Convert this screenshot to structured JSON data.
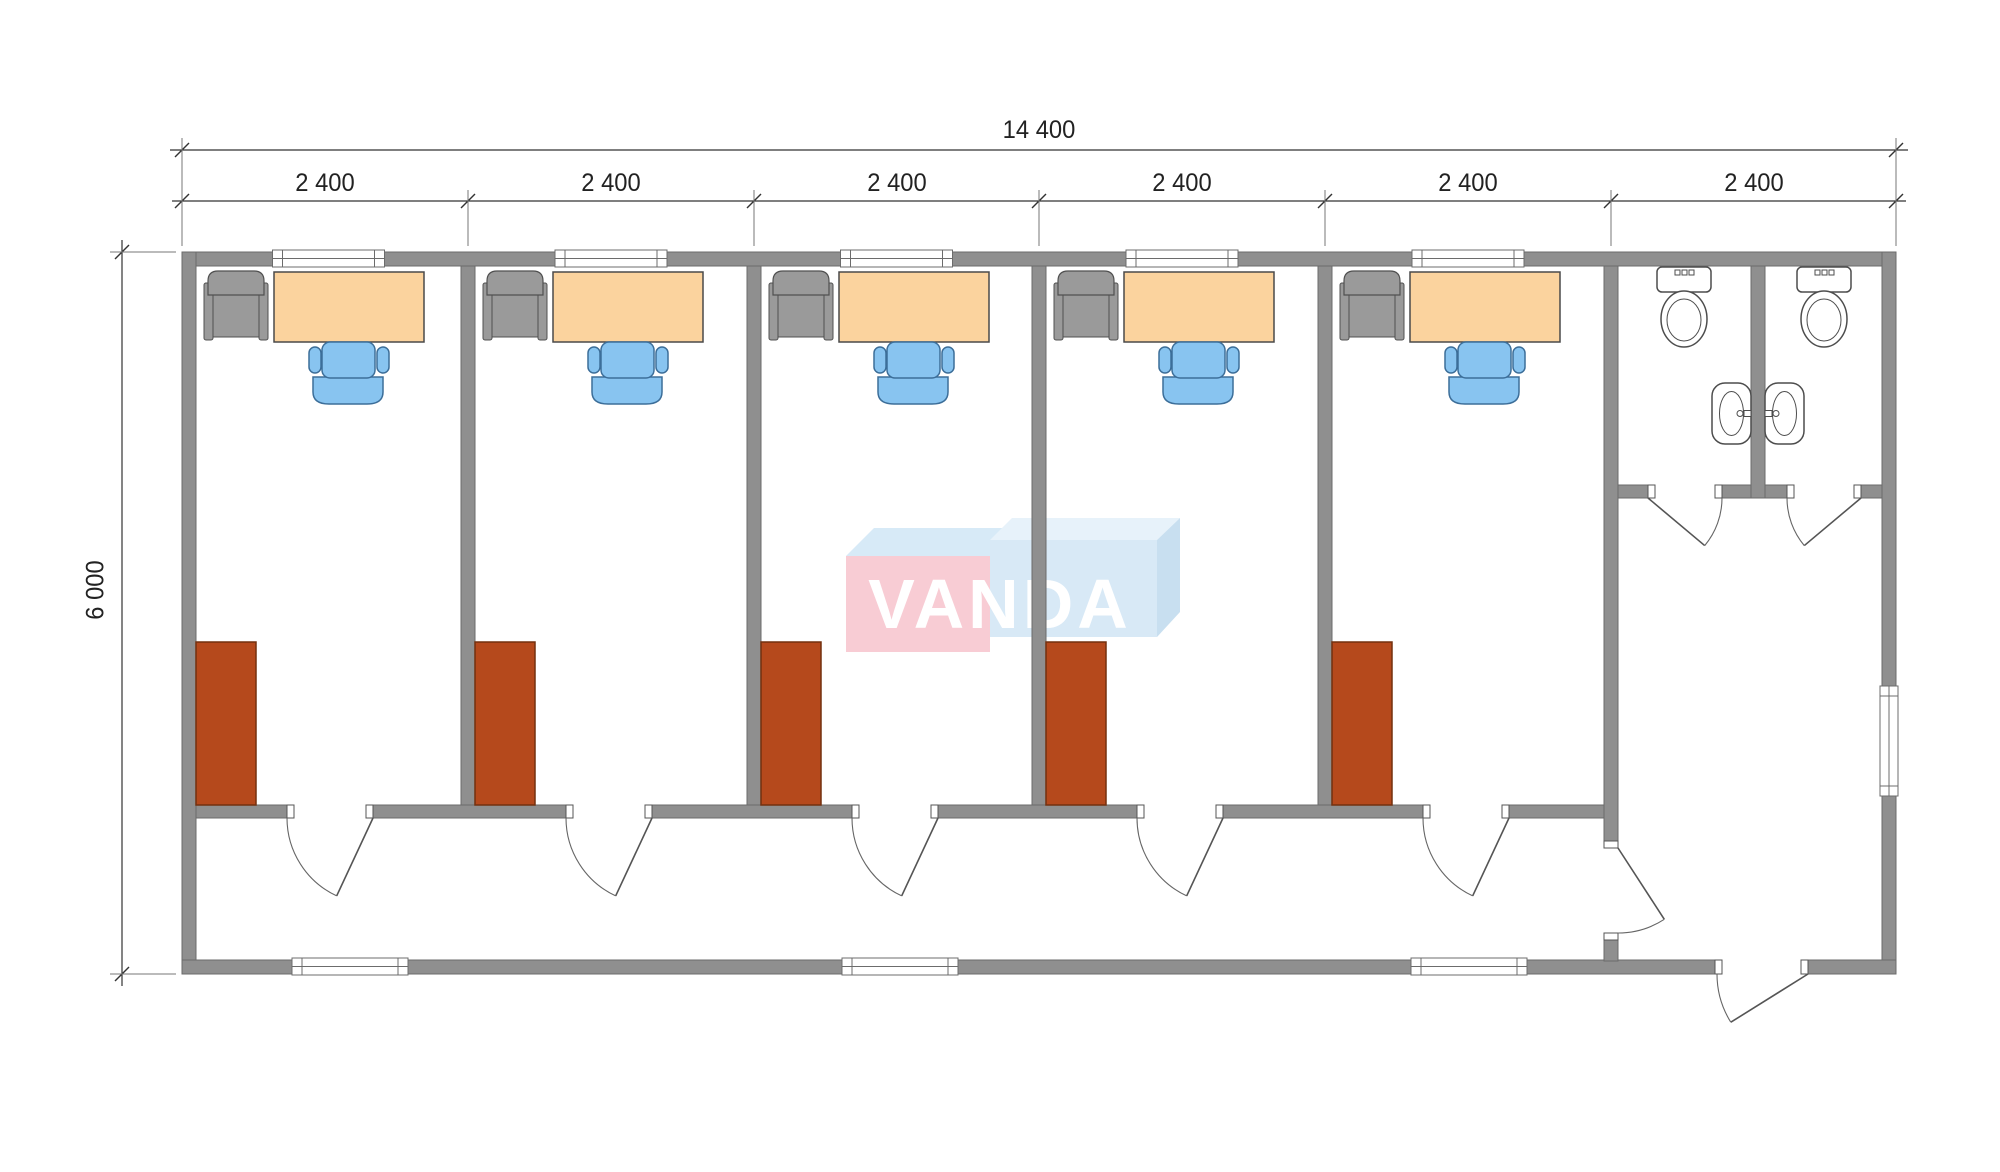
{
  "watermark": {
    "text": "VANDA"
  },
  "dimensions": {
    "total": "14 400",
    "segments": [
      "2 400",
      "2 400",
      "2 400",
      "2 400",
      "2 400",
      "2 400"
    ],
    "height": "6 000"
  },
  "colors": {
    "wall": "#8f8f8f",
    "wallEdge": "#6b6b6b",
    "line": "#4d4d4d",
    "dim": "#333333",
    "desk": "#fbd39e",
    "deskEdge": "#4a4a4a",
    "armchair": "#9a9a9a",
    "armchairEdge": "#505050",
    "chair": "#88c4f0",
    "chairEdge": "#3c6e99",
    "wardrobe": "#b5491c",
    "wardrobeEdge": "#73300f",
    "windowFrame": "#6c6c6c",
    "wmPinkFront": "#f8ccd4",
    "wmPinkTop": "#d7eaf7",
    "wmBlueFront": "#d8e9f6",
    "wmBlueTop": "#e7f2fa",
    "wmBlueSide": "#c8dff0",
    "wmText": "#ffffff"
  },
  "plan": {
    "canvas": {
      "w": 2000,
      "h": 1172
    },
    "wallThickness": 14,
    "outer": {
      "x1": 182,
      "y1": 252,
      "x2": 1896,
      "y2": 974
    },
    "boundaries": [
      182,
      468,
      754,
      1039,
      1325,
      1611,
      1896
    ],
    "dividers": [
      461,
      747,
      1032,
      1318
    ],
    "rooms": [
      {
        "x": 196,
        "w": 265
      },
      {
        "x": 475,
        "w": 272
      },
      {
        "x": 761,
        "w": 271
      },
      {
        "x": 1046,
        "w": 272
      },
      {
        "x": 1332,
        "w": 272
      }
    ],
    "roomBottomWall": {
      "y": 805,
      "h": 13
    },
    "toiletWall": {
      "x": 1604,
      "seg1": [
        266,
        841
      ],
      "seg2": [
        940,
        961
      ]
    },
    "stallWall": {
      "y": 485,
      "h": 13,
      "x1": 1618,
      "x2": 1882,
      "openings": [
        [
          1648,
          1722
        ],
        [
          1787,
          1861
        ]
      ]
    },
    "centralWall": {
      "x": 1751,
      "y1": 266,
      "y2": 498
    },
    "entranceOpening": [
      1715,
      1808
    ],
    "furn": {
      "desk": {
        "dx": 78,
        "y": 272,
        "w": 150,
        "h": 70
      },
      "armrestL": {
        "dx": 8,
        "y": 283,
        "w": 9,
        "h": 57
      },
      "armrestR": {
        "dx": 63,
        "y": 283,
        "w": 9,
        "h": 57
      },
      "armSeat": {
        "dx": 15,
        "y": 287,
        "w": 50,
        "h": 50
      },
      "armBack": {
        "dx": 12,
        "y": 271,
        "w": 56,
        "h": 24
      },
      "chairSeat": {
        "dx": 126,
        "y": 342,
        "w": 53,
        "h": 36
      },
      "chairArmL": {
        "dx": 113,
        "y": 347,
        "w": 12,
        "h": 26
      },
      "chairArmR": {
        "dx": 181,
        "y": 347,
        "w": 12,
        "h": 26
      },
      "chairBack": {
        "dx": 117,
        "y": 377,
        "w": 70,
        "h": 27
      },
      "wardrobe": {
        "dx": 0,
        "y": 642,
        "w": 60,
        "h": 163
      },
      "door": {
        "dx1": 91,
        "dx2": 177,
        "r": 86,
        "a0": 180,
        "a1": 115,
        "sweep": 0
      }
    },
    "windowsTop": {
      "y": 250,
      "h": 17,
      "w": 112
    },
    "windowsBottom": {
      "y": 958,
      "h": 17,
      "w": 116,
      "centers": [
        350,
        900,
        1469
      ]
    },
    "sideWindow": {
      "x": 1880,
      "y": 686,
      "w": 18,
      "h": 110
    },
    "toilets": {
      "cx": [
        1684,
        1824
      ],
      "tankY": 267,
      "tankW": 54,
      "tankH": 25,
      "bowlCy": 319,
      "bowlRx": 23,
      "bowlRy": 28
    },
    "sink": {
      "basins": [
        1712,
        1765
      ],
      "y": 383,
      "w": 39,
      "h": 61
    },
    "doors": [
      {
        "name": "toilet-door-1",
        "hinge": [
          1648,
          498
        ],
        "r": 74,
        "a0": 0,
        "a1": 40,
        "sweep": 1
      },
      {
        "name": "toilet-door-2",
        "hinge": [
          1861,
          498
        ],
        "r": 74,
        "a0": 180,
        "a1": 140,
        "sweep": 0
      },
      {
        "name": "hall-door",
        "hinge": [
          1618,
          848
        ],
        "r": 85,
        "a0": 90,
        "a1": 57,
        "sweep": 0
      },
      {
        "name": "entrance-door",
        "hinge": [
          1808,
          974
        ],
        "r": 91,
        "a0": 180,
        "a1": 148,
        "sweep": 0
      }
    ],
    "jambs": [
      [
        1648,
        485,
        7,
        13
      ],
      [
        1715,
        485,
        7,
        13
      ],
      [
        1787,
        485,
        7,
        13
      ],
      [
        1854,
        485,
        7,
        13
      ],
      [
        1604,
        841,
        14,
        7
      ],
      [
        1604,
        933,
        14,
        7
      ],
      [
        1715,
        960,
        7,
        14
      ],
      [
        1801,
        960,
        7,
        14
      ]
    ],
    "wm": {
      "pinkTop": "846,556 874,528 1018,528 990,556",
      "pinkFront": {
        "x": 846,
        "y": 556,
        "w": 144,
        "h": 96
      },
      "blueTop": "990,540 1012,518 1180,518 1157,540",
      "blueSide": "1157,540 1180,518 1180,612 1157,637",
      "blueFront": {
        "x": 990,
        "y": 540,
        "w": 167,
        "h": 97
      },
      "tx": 1000,
      "ty": 628,
      "fs": 70
    },
    "dims": {
      "topLineY": 150,
      "segLineY": 201,
      "leftLineX": 122
    }
  }
}
